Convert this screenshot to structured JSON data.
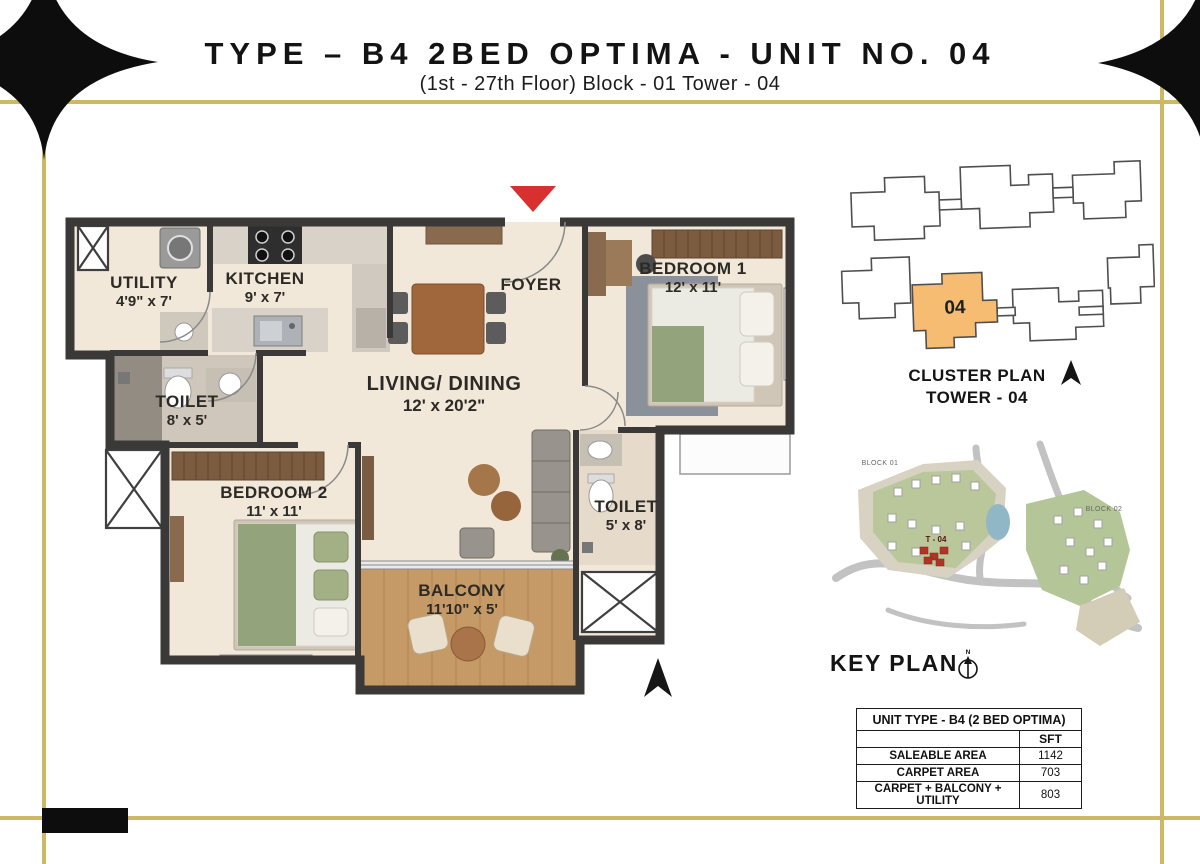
{
  "title": {
    "main": "TYPE – B4 2BED OPTIMA - UNIT NO. 04",
    "subtitle": "(1st - 27th Floor) Block - 01  Tower - 04"
  },
  "plan": {
    "rooms": [
      {
        "name": "UTILITY",
        "dims": "4'9\" x 7'"
      },
      {
        "name": "KITCHEN",
        "dims": "9' x 7'"
      },
      {
        "name": "FOYER",
        "dims": ""
      },
      {
        "name": "LIVING/ DINING",
        "dims": "12' x 20'2\""
      },
      {
        "name": "BEDROOM 1",
        "dims": "12' x 11'"
      },
      {
        "name": "TOILET",
        "dims": "8' x 5'"
      },
      {
        "name": "BEDROOM 2",
        "dims": "11' x 11'"
      },
      {
        "name": "TOILET",
        "dims": "5' x 8'"
      },
      {
        "name": "BALCONY",
        "dims": "11'10\" x 5'"
      }
    ]
  },
  "cluster_plan": {
    "line1": "CLUSTER PLAN",
    "line2": "TOWER - 04",
    "unit_number": "04"
  },
  "key_plan": {
    "title": "KEY PLAN",
    "block_01": "BLOCK 01",
    "block_02": "BLOCK 02",
    "tower_label": "T - 04",
    "north_letter": "N"
  },
  "area_table": {
    "title": "UNIT TYPE - B4 (2 BED OPTIMA)",
    "col_header": "SFT",
    "rows": [
      {
        "label": "SALEABLE AREA",
        "value": "1142"
      },
      {
        "label": "CARPET AREA",
        "value": "703"
      },
      {
        "label": "CARPET + BALCONY + UTILITY",
        "value": "803"
      }
    ]
  },
  "colors": {
    "gold": "#cdb965",
    "highlight": "#f6bc72",
    "arrow": "#d8302f",
    "wall": "#3a3938"
  }
}
